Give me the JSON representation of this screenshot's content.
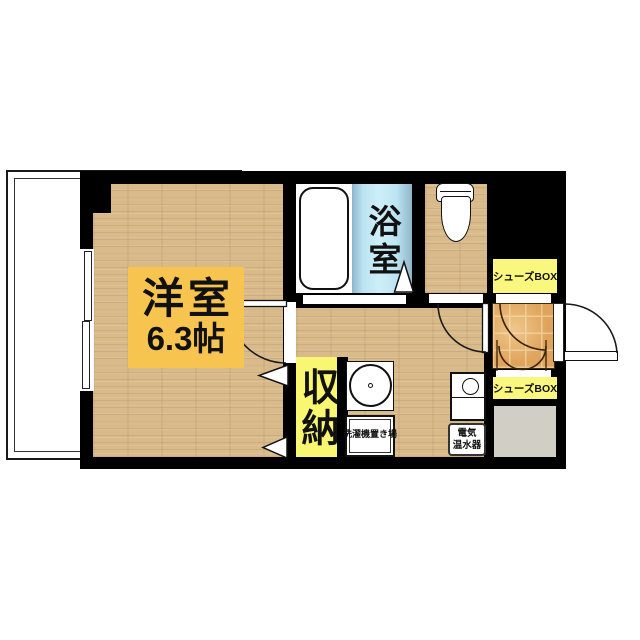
{
  "labels": {
    "main_room": {
      "name": "洋室",
      "size": "6.3帖"
    },
    "bathroom": {
      "name": "浴室"
    },
    "closet": {
      "name": "収納"
    },
    "shoes_box_upper": {
      "name": "シューズBOX"
    },
    "shoes_box_lower": {
      "name": "シューズBOX"
    },
    "water_heater": {
      "line1": "電気",
      "line2": "温水器"
    },
    "laundry": {
      "name": "洗濯機置き場"
    }
  },
  "colors": {
    "wall": "#000000",
    "wood_floor": "#D9BA8B",
    "bath_blue": "#C4E8F4",
    "room_label_bg": "#F6C44F",
    "highlight_yellow": "#F9F772",
    "entrance_tile": "#DFA35B",
    "storage_gray": "#D1CFC5"
  }
}
